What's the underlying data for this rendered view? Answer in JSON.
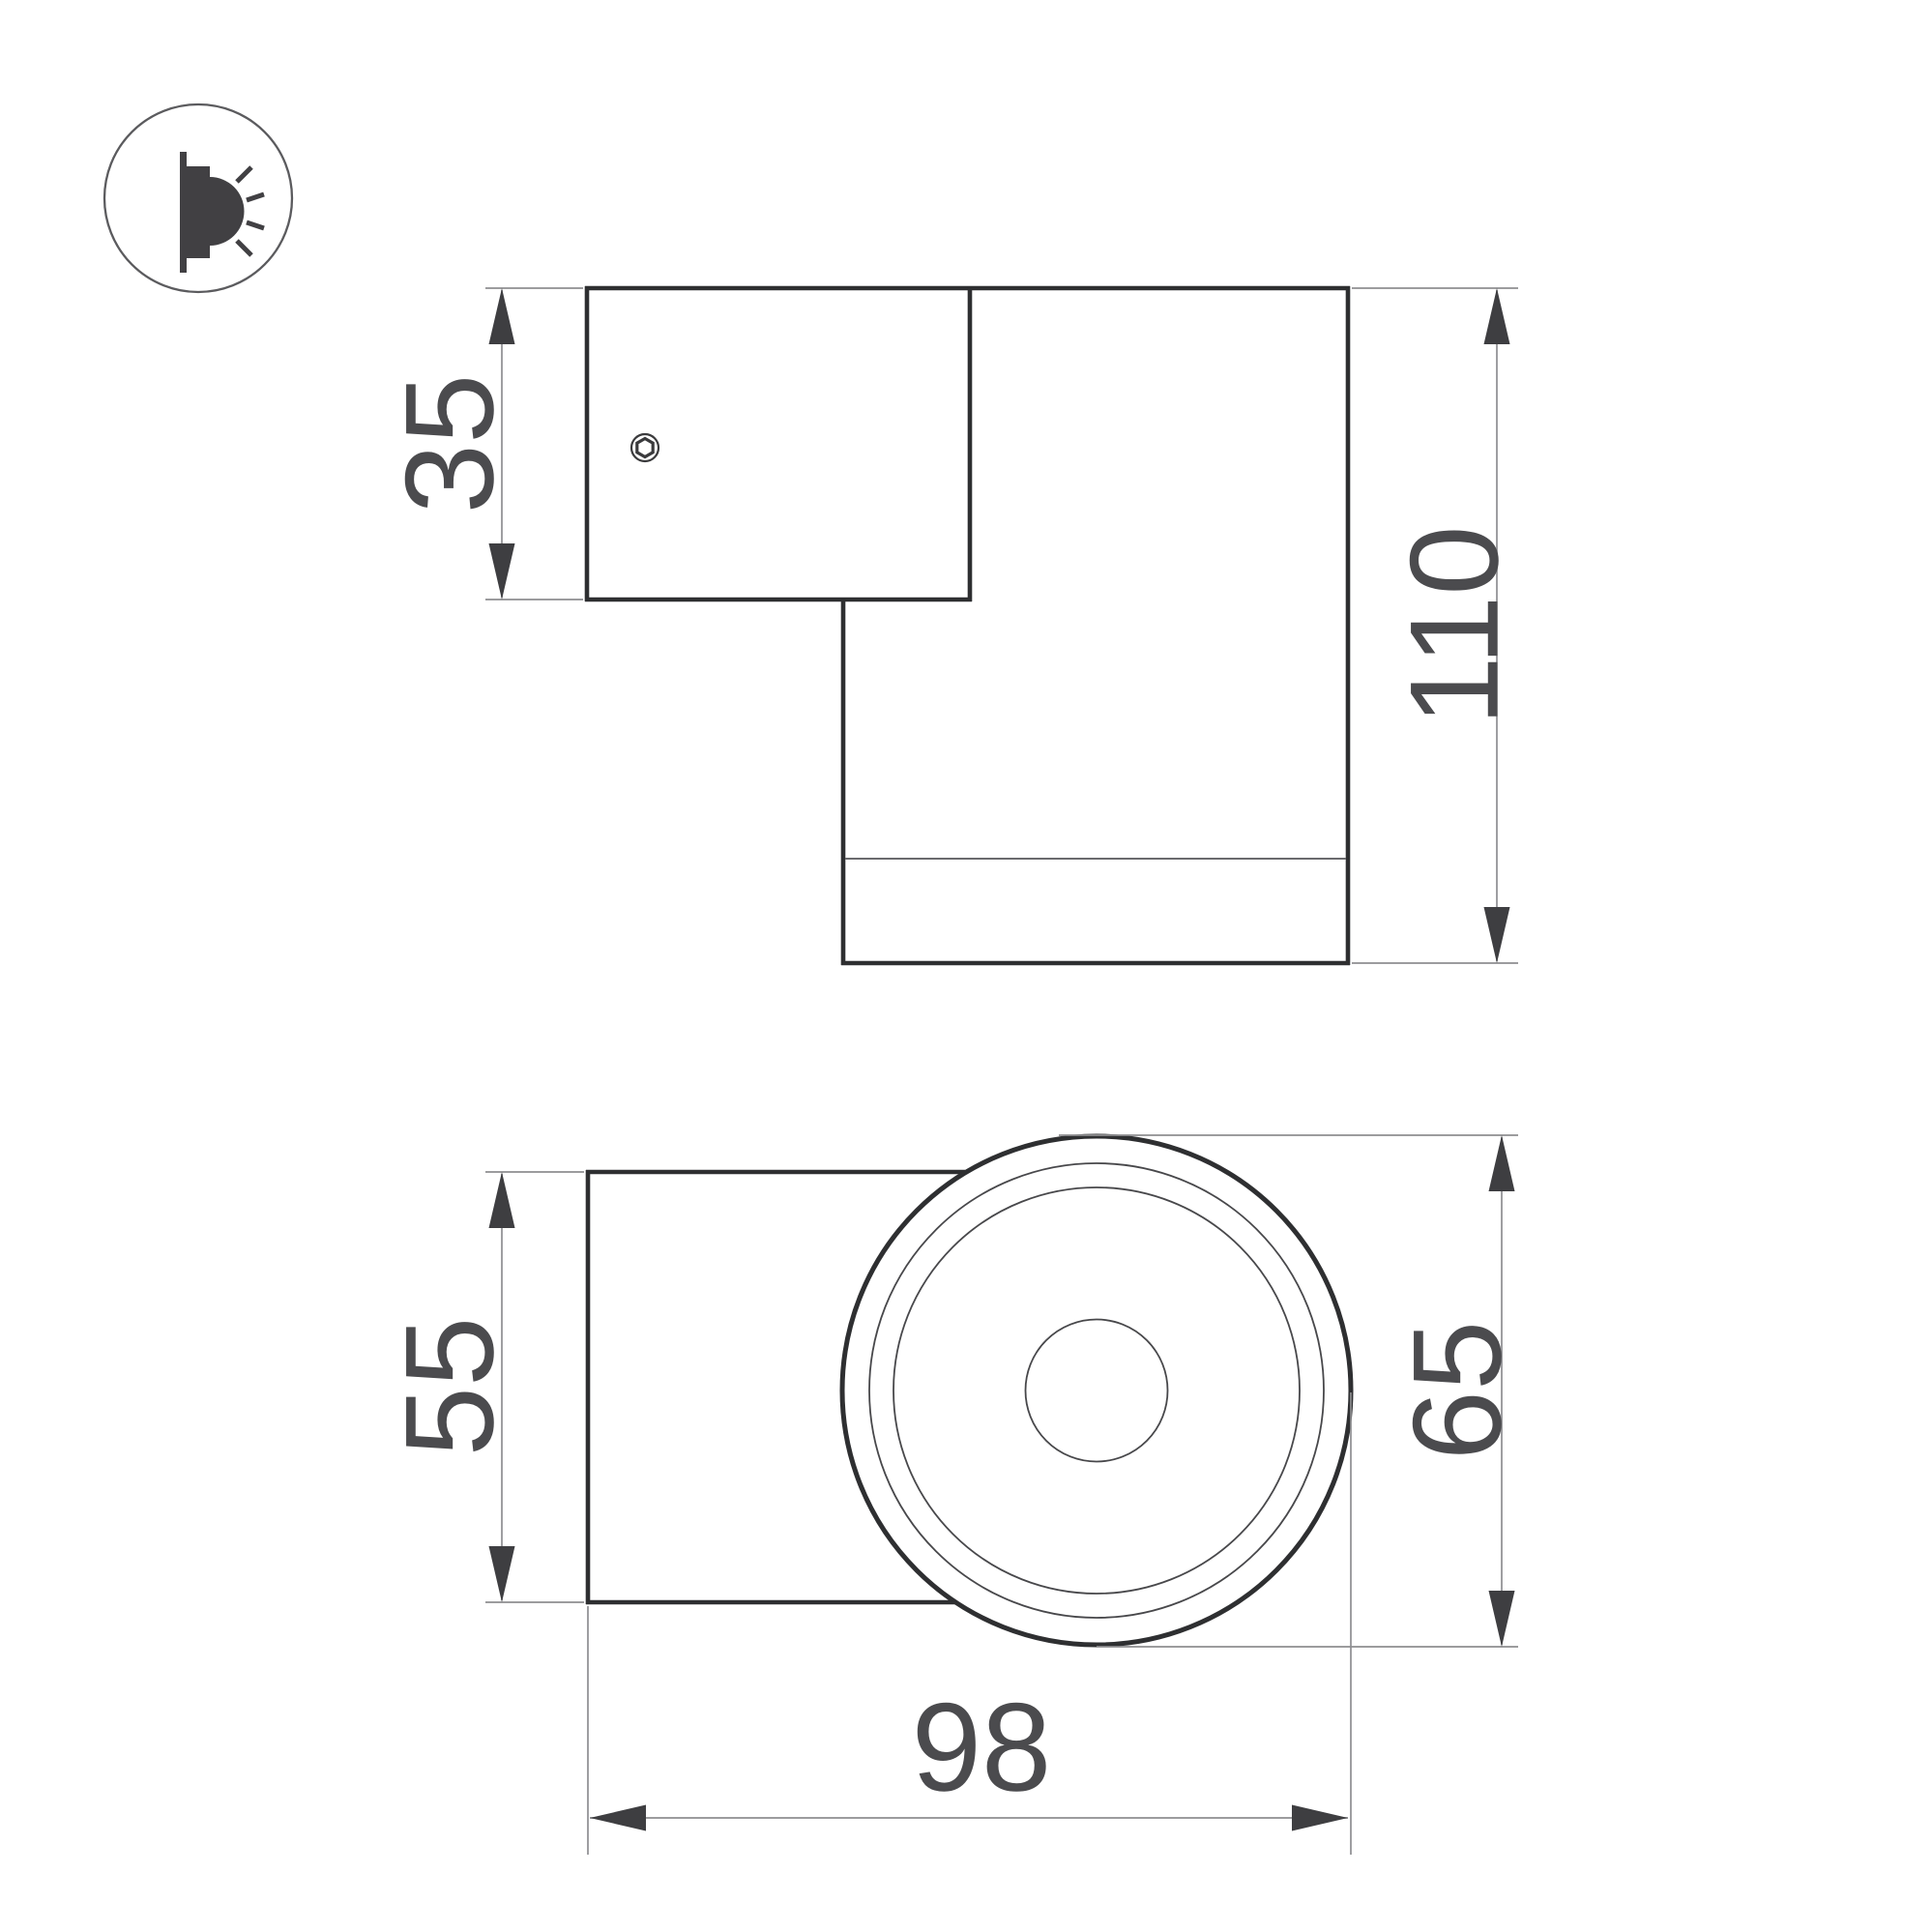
{
  "drawing": {
    "background": "#ffffff",
    "colors": {
      "outline": "#2e2f31",
      "inner_line": "#48484b",
      "rim_line": "#6b6b6e",
      "dimension_line": "#8e8e91",
      "arrow": "#3e3e41",
      "label_text": "#4b4b4e",
      "icon_ink": "#414043",
      "icon_ring": "#5b5b5e"
    },
    "icon": {
      "name": "wall-mounted-downlight-icon"
    },
    "side_view": {
      "plate_height_label": "35",
      "body_height_label": "110"
    },
    "front_view": {
      "plate_width_label": "55",
      "body_diameter_label": "65",
      "total_depth_label": "98"
    }
  }
}
